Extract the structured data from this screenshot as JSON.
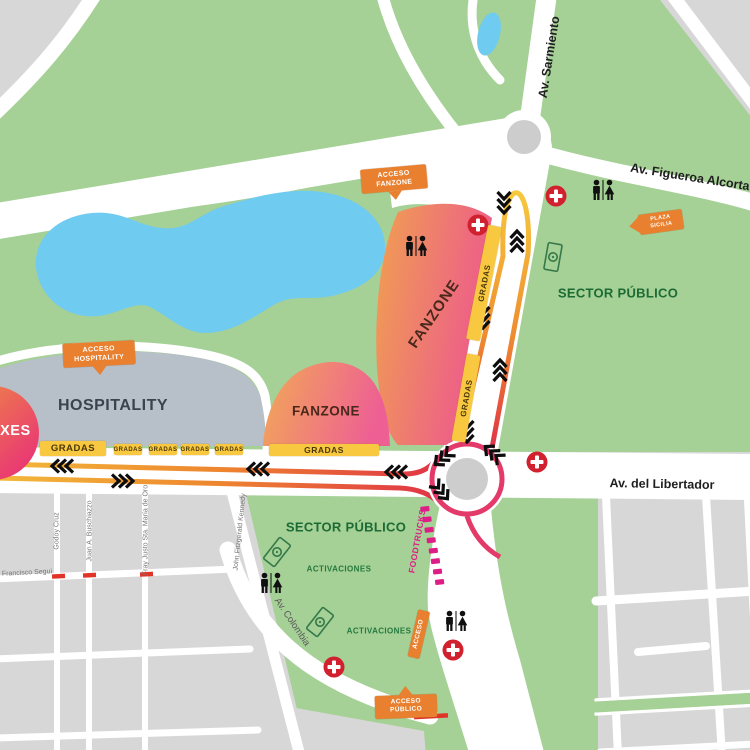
{
  "streets": {
    "sarmiento": "Av. Sarmiento",
    "figueroa_alcorta": "Av. Figueroa Alcorta",
    "libertador": "Av. del Libertador",
    "colombia": "Av. Colombia",
    "godoy_cruz": "Godoy Cruz",
    "juan_buschiazzo": "Juan A. Buschiazzo",
    "fray_justo": "Fray Justo Sta. María de Oro",
    "kennedy": "John Fitzgerald Kennedy",
    "francisco_segui": "Francisco Segui"
  },
  "zones": {
    "hospitality": "HOSPITALITY",
    "fanzone": "FANZONE",
    "sector_publico": "SECTOR PÚBLICO",
    "boxes": "BOXES",
    "activaciones": "ACTIVACIONES",
    "foodtrucks": "FOODTRUCKS",
    "gradas": "GRADAS"
  },
  "badges": {
    "acceso_fanzone": "ACCESO FANZONE",
    "acceso_hospitality": "ACCESO HOSPITALITY",
    "acceso_publico": "ACCESO PÚBLICO",
    "acceso": "ACCESO",
    "plaza_sicilia": "PLAZA SICILIA"
  },
  "colors": {
    "park_green": "#a5d096",
    "city_gray": "#d7d7d7",
    "water_blue": "#70cbf0",
    "hospitality_gray": "#b7bfc8",
    "gradas_yellow": "#f8c840",
    "badge_orange": "#e8802f",
    "medical_red": "#d1202e",
    "foodtrucks_magenta": "#df1d86",
    "track_yellow": "#f6c83e",
    "track_orange": "#ef8d2f",
    "track_red": "#e03347",
    "track_pink": "#e43a6a",
    "sector_text_green": "#1c6b35"
  }
}
